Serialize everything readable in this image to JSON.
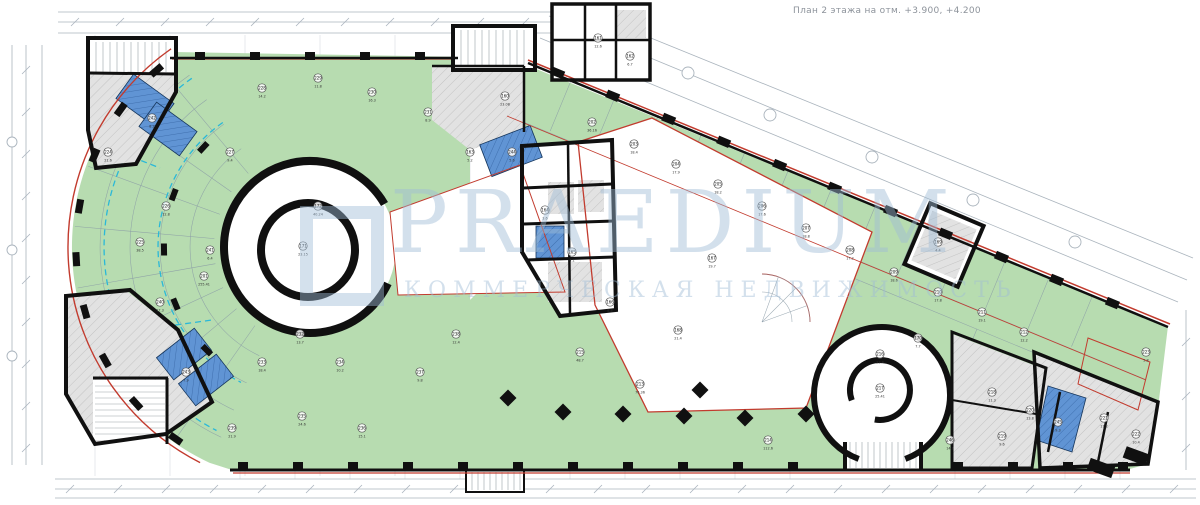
{
  "title": "План 2 этажа на отм. +3.900, +4.200",
  "watermark": {
    "text": "PRAEDIUM",
    "subtitle": "КОММЕРЧЕСКАЯ НЕДВИЖИМОСТЬ"
  },
  "colors": {
    "green": "#b7dcb0",
    "blue": "#6094d4",
    "blueLine": "#3f6fae",
    "gray": "#e2e2e2",
    "grayLine": "#c3c3c3",
    "wall": "#101010",
    "red": "#c23b2e",
    "cyan": "#2ab8d8",
    "dim": "#aab4bd",
    "thin": "#8a9aa6",
    "watermark": "#9fbcd6"
  },
  "rooms": [
    {
      "n": "160",
      "a": "23.08",
      "x": 505,
      "y": 96
    },
    {
      "n": "161",
      "a": "12.6",
      "x": 598,
      "y": 38
    },
    {
      "n": "162",
      "a": "6.7",
      "x": 630,
      "y": 56
    },
    {
      "n": "163",
      "a": "5.2",
      "x": 470,
      "y": 152
    },
    {
      "n": "164",
      "a": "3.6",
      "x": 545,
      "y": 210
    },
    {
      "n": "165",
      "a": "4.1",
      "x": 572,
      "y": 252
    },
    {
      "n": "166",
      "a": "8.8",
      "x": 610,
      "y": 302
    },
    {
      "n": "167",
      "a": "19.7",
      "x": 712,
      "y": 258
    },
    {
      "n": "168",
      "a": "21.4",
      "x": 678,
      "y": 330
    },
    {
      "n": "169",
      "a": "4.4",
      "x": 938,
      "y": 242
    },
    {
      "n": "170",
      "a": "7.7",
      "x": 918,
      "y": 338
    },
    {
      "n": "171",
      "a": "23.15",
      "x": 303,
      "y": 246
    },
    {
      "n": "172",
      "a": "40.24",
      "x": 318,
      "y": 206
    },
    {
      "n": "201",
      "a": "255.41",
      "x": 204,
      "y": 276
    },
    {
      "n": "202",
      "a": "36.16",
      "x": 592,
      "y": 122
    },
    {
      "n": "203",
      "a": "18.4",
      "x": 634,
      "y": 144
    },
    {
      "n": "204",
      "a": "17.9",
      "x": 676,
      "y": 164
    },
    {
      "n": "205",
      "a": "18.2",
      "x": 718,
      "y": 184
    },
    {
      "n": "206",
      "a": "17.6",
      "x": 762,
      "y": 206
    },
    {
      "n": "207",
      "a": "18.8",
      "x": 806,
      "y": 228
    },
    {
      "n": "208",
      "a": "17.2",
      "x": 850,
      "y": 250
    },
    {
      "n": "209",
      "a": "18.6",
      "x": 894,
      "y": 272
    },
    {
      "n": "210",
      "a": "17.8",
      "x": 938,
      "y": 292
    },
    {
      "n": "211",
      "a": "19.1",
      "x": 982,
      "y": 312
    },
    {
      "n": "212",
      "a": "12.2",
      "x": 1024,
      "y": 332
    },
    {
      "n": "213",
      "a": "76.36",
      "x": 640,
      "y": 384
    },
    {
      "n": "214",
      "a": "112.6",
      "x": 768,
      "y": 440
    },
    {
      "n": "215",
      "a": "48.7",
      "x": 580,
      "y": 352
    },
    {
      "n": "216",
      "a": "23.4",
      "x": 880,
      "y": 354
    },
    {
      "n": "217",
      "a": "25.41",
      "x": 880,
      "y": 388
    },
    {
      "n": "218",
      "a": "11.3",
      "x": 992,
      "y": 392
    },
    {
      "n": "219",
      "a": "9.6",
      "x": 1002,
      "y": 436
    },
    {
      "n": "220",
      "a": "13.8",
      "x": 1030,
      "y": 410
    },
    {
      "n": "221",
      "a": "17.2",
      "x": 1104,
      "y": 418
    },
    {
      "n": "222",
      "a": "10.4",
      "x": 1136,
      "y": 434
    },
    {
      "n": "223",
      "a": "5.8",
      "x": 1146,
      "y": 352
    },
    {
      "n": "224",
      "a": "21.6",
      "x": 108,
      "y": 152
    },
    {
      "n": "225",
      "a": "38.5",
      "x": 140,
      "y": 242
    },
    {
      "n": "226",
      "a": "12.8",
      "x": 166,
      "y": 206
    },
    {
      "n": "227",
      "a": "9.4",
      "x": 230,
      "y": 152
    },
    {
      "n": "228",
      "a": "14.2",
      "x": 262,
      "y": 88
    },
    {
      "n": "229",
      "a": "11.8",
      "x": 318,
      "y": 78
    },
    {
      "n": "230",
      "a": "16.3",
      "x": 372,
      "y": 92
    },
    {
      "n": "231",
      "a": "8.9",
      "x": 428,
      "y": 112
    },
    {
      "n": "232",
      "a": "13.7",
      "x": 300,
      "y": 334
    },
    {
      "n": "233",
      "a": "18.4",
      "x": 262,
      "y": 362
    },
    {
      "n": "234",
      "a": "10.2",
      "x": 340,
      "y": 362
    },
    {
      "n": "235",
      "a": "24.6",
      "x": 302,
      "y": 416
    },
    {
      "n": "236",
      "a": "15.1",
      "x": 362,
      "y": 428
    },
    {
      "n": "237",
      "a": "9.8",
      "x": 420,
      "y": 372
    },
    {
      "n": "238",
      "a": "12.4",
      "x": 456,
      "y": 334
    },
    {
      "n": "239",
      "a": "21.9",
      "x": 232,
      "y": 428
    },
    {
      "n": "240",
      "a": "17.3",
      "x": 160,
      "y": 302
    },
    {
      "n": "241",
      "a": "6.4",
      "x": 210,
      "y": 250
    },
    {
      "n": "242",
      "a": "8.2",
      "x": 152,
      "y": 118
    },
    {
      "n": "243",
      "a": "7.9",
      "x": 186,
      "y": 372
    },
    {
      "n": "244",
      "a": "5.6",
      "x": 512,
      "y": 152
    },
    {
      "n": "245",
      "a": "9.3",
      "x": 1058,
      "y": 422
    },
    {
      "n": "246",
      "a": "14.8",
      "x": 950,
      "y": 440
    }
  ]
}
